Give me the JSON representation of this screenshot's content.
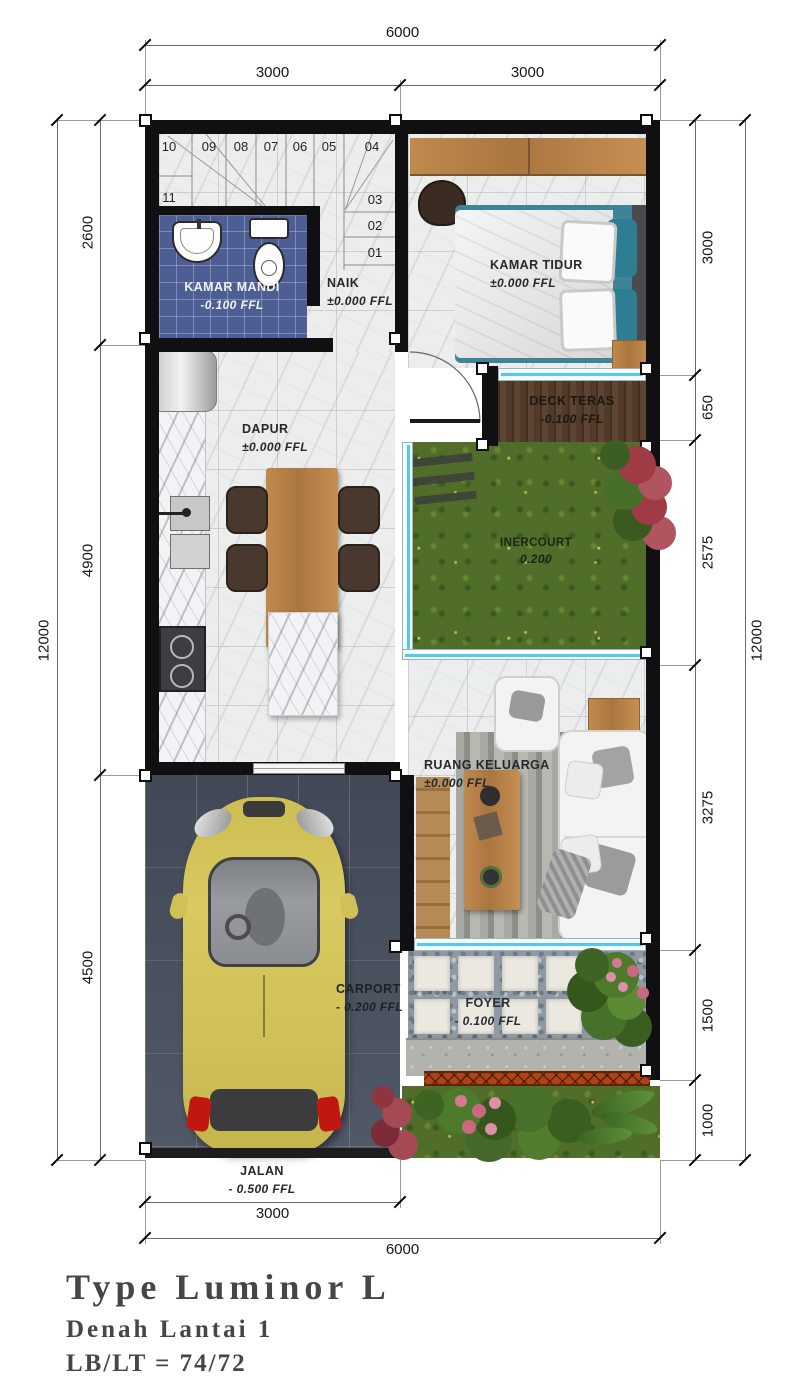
{
  "plan": {
    "rooms": {
      "kamar_mandi": {
        "name": "KAMAR MANDI",
        "level": "-0.100 FFL"
      },
      "naik": {
        "name": "NAIK",
        "level": "±0.000 FFL"
      },
      "kamar_tidur": {
        "name": "KAMAR TIDUR",
        "level": "±0.000 FFL"
      },
      "deck_teras": {
        "name": "DECK TERAS",
        "level": "-0.100 FFL"
      },
      "inercourt": {
        "name": "INERCOURT",
        "level": "0.200"
      },
      "dapur": {
        "name": "DAPUR",
        "level": "±0.000 FFL"
      },
      "ruang_keluarga": {
        "name": "RUANG KELUARGA",
        "level": "±0.000 FFL"
      },
      "carport": {
        "name": "CARPORT",
        "level": "- 0.200 FFL"
      },
      "foyer": {
        "name": "FOYER",
        "level": "- 0.100 FFL"
      },
      "jalan": {
        "name": "JALAN",
        "level": "- 0.500 FFL"
      }
    },
    "stairs": {
      "top_row": [
        "10",
        "09",
        "08",
        "07",
        "06",
        "05",
        "04"
      ],
      "landing": "11",
      "right_column": [
        "03",
        "02",
        "01"
      ]
    },
    "dimensions": {
      "top": {
        "overall": "6000",
        "segments": [
          "3000",
          "3000"
        ]
      },
      "left": {
        "overall": "12000",
        "segments": [
          "2600",
          "4900",
          "4500"
        ]
      },
      "right": {
        "overall": "12000",
        "segments": [
          "3000",
          "650",
          "2575",
          "3275",
          "1500",
          "1000"
        ]
      },
      "bottom": {
        "overall": "6000",
        "segment": "3000"
      }
    }
  },
  "title_block": {
    "type": "Type Luminor L",
    "floor": "Denah Lantai 1",
    "ratio": "LB/LT = 74/72"
  },
  "colors": {
    "wall": "#101012",
    "bathroom_tile": "#4d5e95",
    "grass": "#516d2a",
    "deck_wood": "#52392a",
    "glazing_blue": "#55c8ec",
    "carport_tile": "#4a5160",
    "car_yellow": "#d5c65b",
    "fence_orange": "#ad4316",
    "furniture_wood": "#bc8d55",
    "marble_floor": "#eceded"
  }
}
